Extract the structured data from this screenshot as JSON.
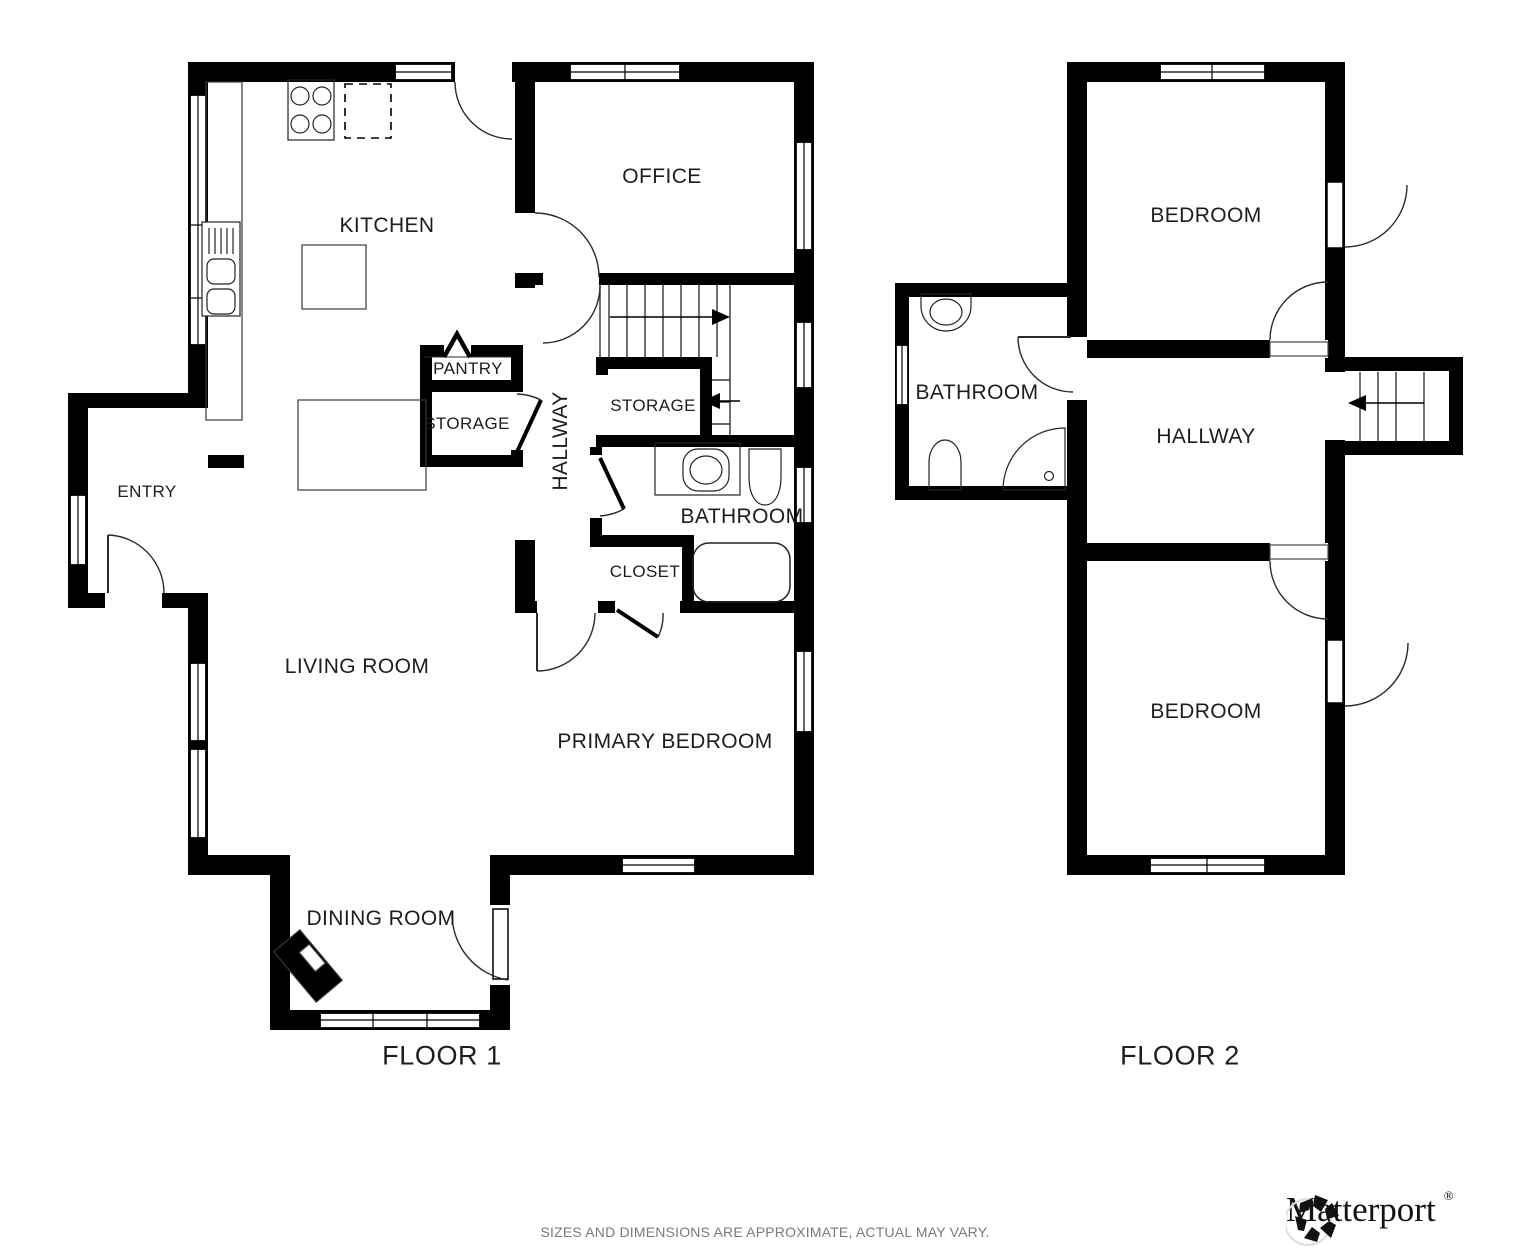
{
  "floor1": {
    "label": "FLOOR 1",
    "rooms": {
      "kitchen": "KITCHEN",
      "office": "OFFICE",
      "pantry": "PANTRY",
      "storage_a": "STORAGE",
      "storage_b": "STORAGE",
      "hallway": "HALLWAY",
      "bathroom": "BATHROOM",
      "closet": "CLOSET",
      "entry": "ENTRY",
      "living_room": "LIVING ROOM",
      "primary_bedroom": "PRIMARY BEDROOM",
      "dining_room": "DINING ROOM"
    }
  },
  "floor2": {
    "label": "FLOOR 2",
    "rooms": {
      "bedroom_top": "BEDROOM",
      "bathroom": "BATHROOM",
      "hallway": "HALLWAY",
      "bedroom_bottom": "BEDROOM"
    }
  },
  "footer": {
    "disclaimer": "SIZES AND DIMENSIONS ARE APPROXIMATE, ACTUAL MAY VARY.",
    "brand": "Matterport",
    "registered": "®"
  },
  "colors": {
    "wall": "#000000",
    "label_text": "#1d1d1d",
    "disclaimer_text": "#7a7a7a",
    "line": "#222222"
  },
  "icons": [
    "stove-icon",
    "dishwasher-icon",
    "kitchen-island-icon",
    "counter-sink-icon",
    "kitchen-table-icon",
    "vanity-sink-icon",
    "toilet-icon",
    "bathtub-icon",
    "shower-icon",
    "piano-icon",
    "stairs-up-arrow-icon",
    "storage-arrow-icon",
    "stairs-down-arrow-icon",
    "matterport-logo-icon"
  ]
}
